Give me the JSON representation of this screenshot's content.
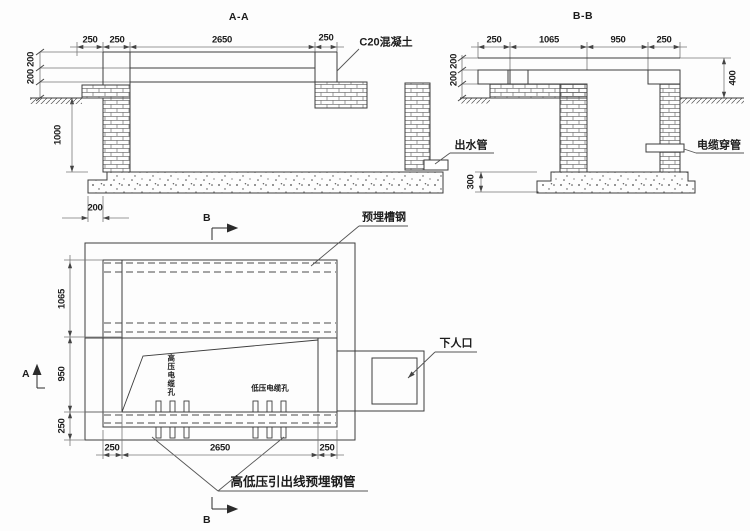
{
  "section_aa": {
    "title": "A-A",
    "dim_top": [
      "250",
      "250",
      "2650",
      "250"
    ],
    "dim_left_upper": "200 200",
    "dim_left_lower": "1000",
    "dim_bottom": "200",
    "label_concrete": "C20混凝土",
    "label_outlet": "出水管"
  },
  "section_bb": {
    "title": "B-B",
    "dim_top": [
      "250",
      "1065",
      "950",
      "250"
    ],
    "dim_left": "200 200",
    "dim_right": "400",
    "dim_foundation": "300",
    "label_conduit": "电缆穿管"
  },
  "plan": {
    "dim_left": [
      "1065",
      "950",
      "250"
    ],
    "dim_bottom": [
      "250",
      "2650",
      "250"
    ],
    "label_channel_steel": "预埋槽钢",
    "label_manhole": "下人口",
    "label_hv_holes": "高压电缆孔",
    "label_lv_holes": "低压电缆孔",
    "label_outlet_pipes": "高低压引出线预埋钢管",
    "marker_a": "A",
    "marker_b": "B"
  },
  "colors": {
    "line": "#3d3d3d",
    "dim_line": "#777777",
    "text": "#1c1c1c"
  }
}
